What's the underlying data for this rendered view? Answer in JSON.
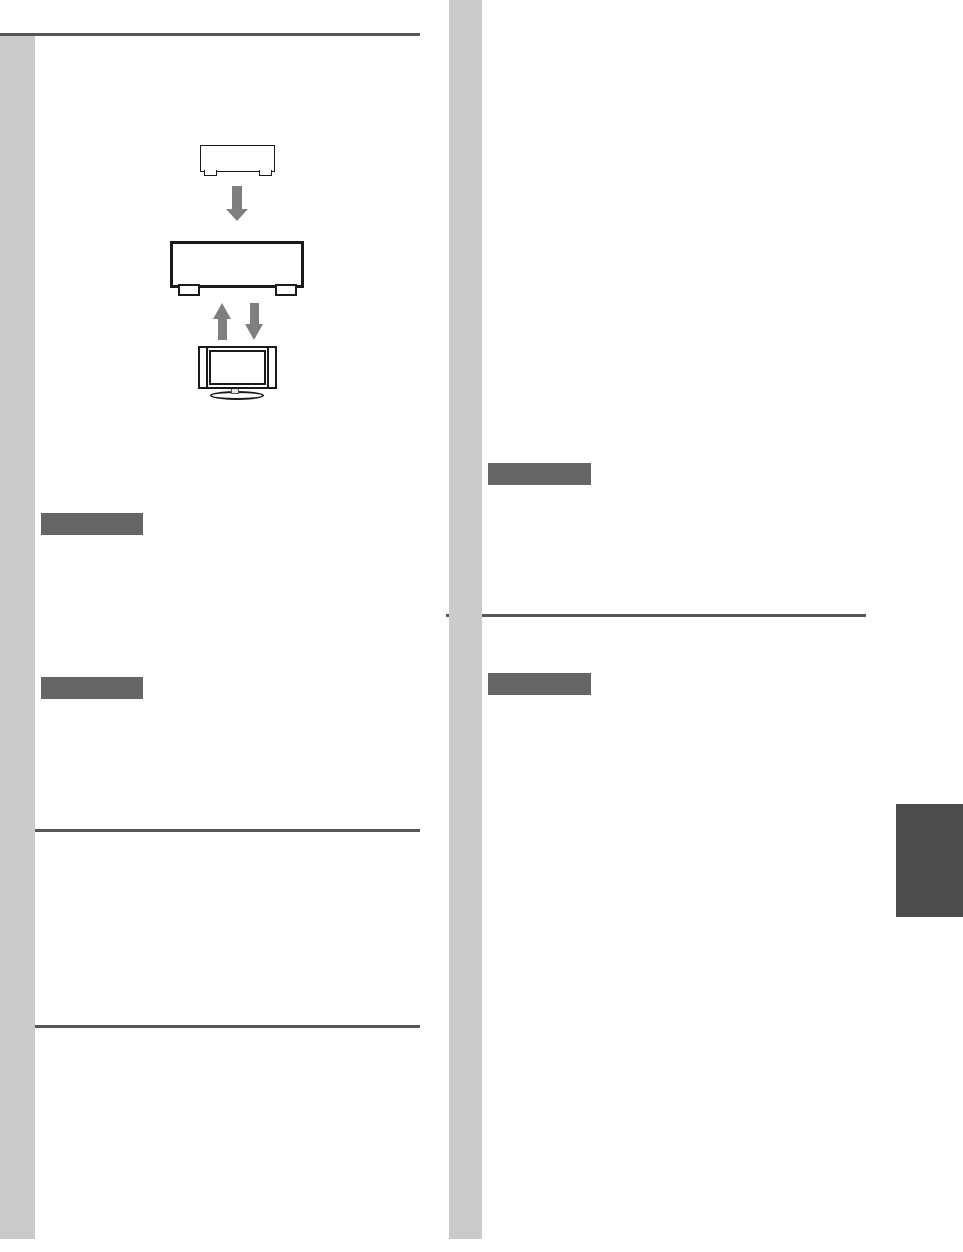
{
  "page": {
    "width_px": 963,
    "height_px": 1252,
    "background": "#ffffff",
    "visible_text": ""
  },
  "colors": {
    "page_bg": "#ffffff",
    "margin_bar": "#cbcbcb",
    "rule": "#565656",
    "heading_block": "#666666",
    "chapter_tab": "#4d4d4d",
    "arrow": "#7f7f7f",
    "line_art": "#1a1a1a",
    "tv_neck_fill": "#e6e6e6"
  },
  "diagram": {
    "icons": [
      "source-component-outline-icon",
      "down-arrow-icon",
      "av-receiver-outline-icon",
      "up-arrow-icon",
      "down-arrow-icon",
      "tv-outline-icon"
    ]
  },
  "heading_blocks": {
    "left_column_count": 2,
    "right_column_count": 2
  },
  "rules": {
    "count": 4
  }
}
